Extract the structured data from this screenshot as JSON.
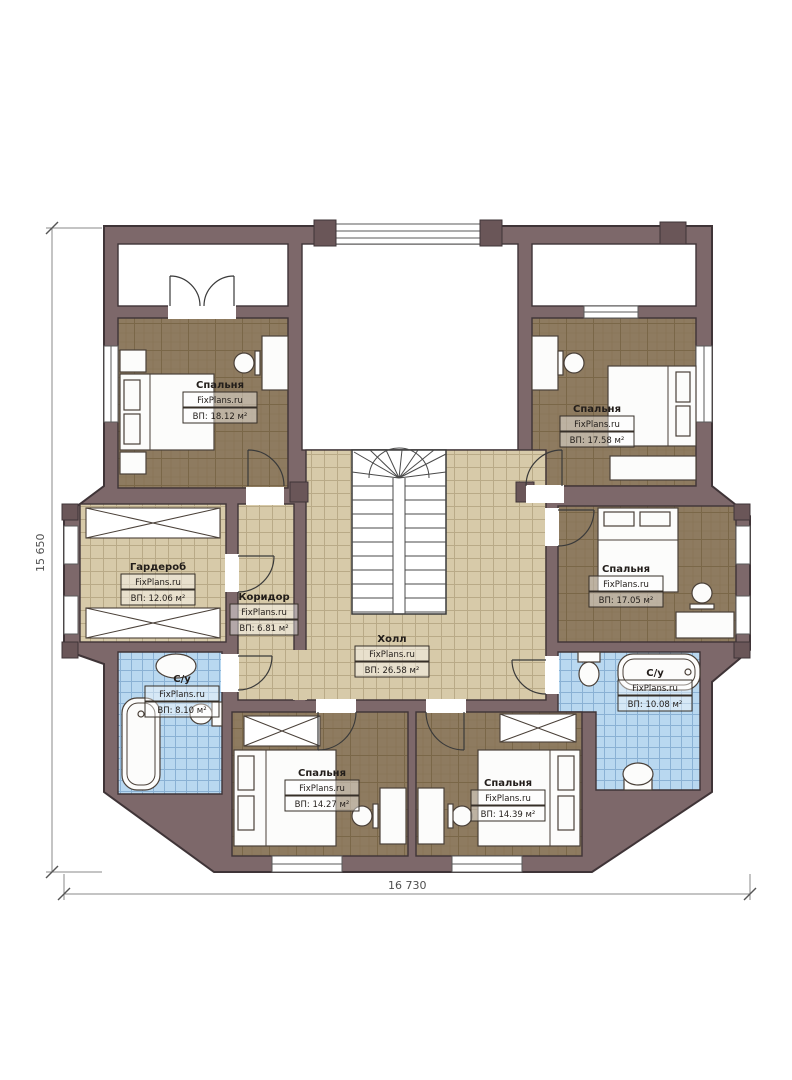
{
  "brand": {
    "watermark": "FixPlans.ru"
  },
  "dimensions": {
    "vertical": "15 650",
    "horizontal": "16 730"
  },
  "rooms": [
    {
      "id": "bedroom-top-left",
      "name": "Спальня",
      "area": "ВП: 18.12 м²"
    },
    {
      "id": "bedroom-top-right",
      "name": "Спальня",
      "area": "ВП: 17.58 м²"
    },
    {
      "id": "bedroom-right",
      "name": "Спальня",
      "area": "ВП: 17.05 м²"
    },
    {
      "id": "wardrobe",
      "name": "Гардероб",
      "area": "ВП: 12.06 м²"
    },
    {
      "id": "corridor",
      "name": "Коридор",
      "area": "ВП: 6.81 м²"
    },
    {
      "id": "hall",
      "name": "Холл",
      "area": "ВП: 26.58 м²"
    },
    {
      "id": "bath-left",
      "name": "С/у",
      "area": "ВП: 8.10 м²"
    },
    {
      "id": "bath-right",
      "name": "С/у",
      "area": "ВП: 10.08 м²"
    },
    {
      "id": "bedroom-bottom-left",
      "name": "Спальня",
      "area": "ВП: 14.27 м²"
    },
    {
      "id": "bedroom-bottom-right",
      "name": "Спальня",
      "area": "ВП: 14.39 м²"
    }
  ],
  "colors": {
    "wall": "#7d686a",
    "wall_outline": "#3f3437",
    "bedroom_floor": "#8e7b60",
    "tile_floor": "#d7caa9",
    "bath_floor": "#b9d8f0",
    "furniture": "#fcfcfb",
    "dimension_text": "#4f4f4f"
  }
}
